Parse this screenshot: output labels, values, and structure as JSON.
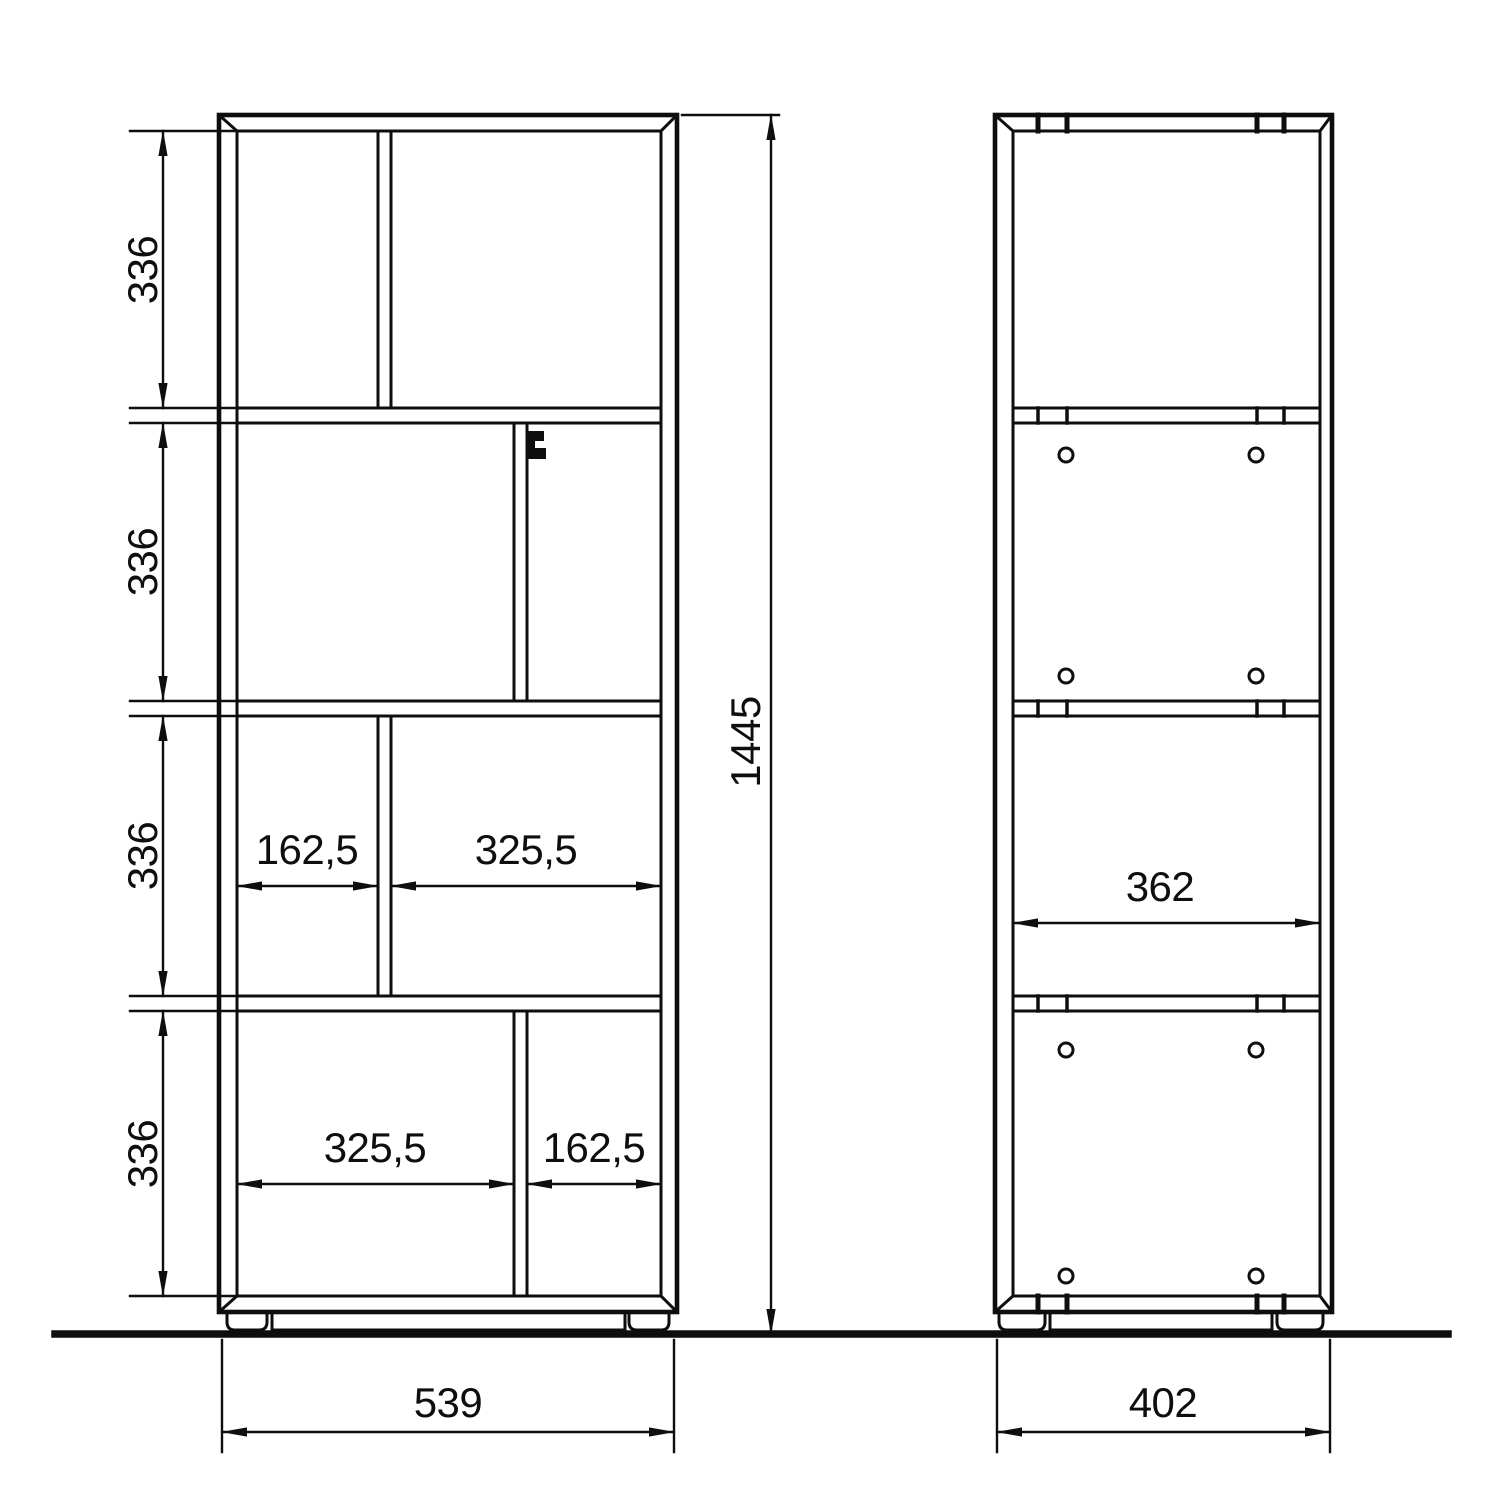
{
  "drawing": {
    "front_view": {
      "height_total": "1445",
      "width_total": "539",
      "section_heights": [
        "336",
        "336",
        "336",
        "336"
      ],
      "row3_left_width": "162,5",
      "row3_right_width": "325,5",
      "row4_left_width": "325,5",
      "row4_right_width": "162,5"
    },
    "side_view": {
      "width_total": "402",
      "shelf_depth": "362"
    }
  }
}
